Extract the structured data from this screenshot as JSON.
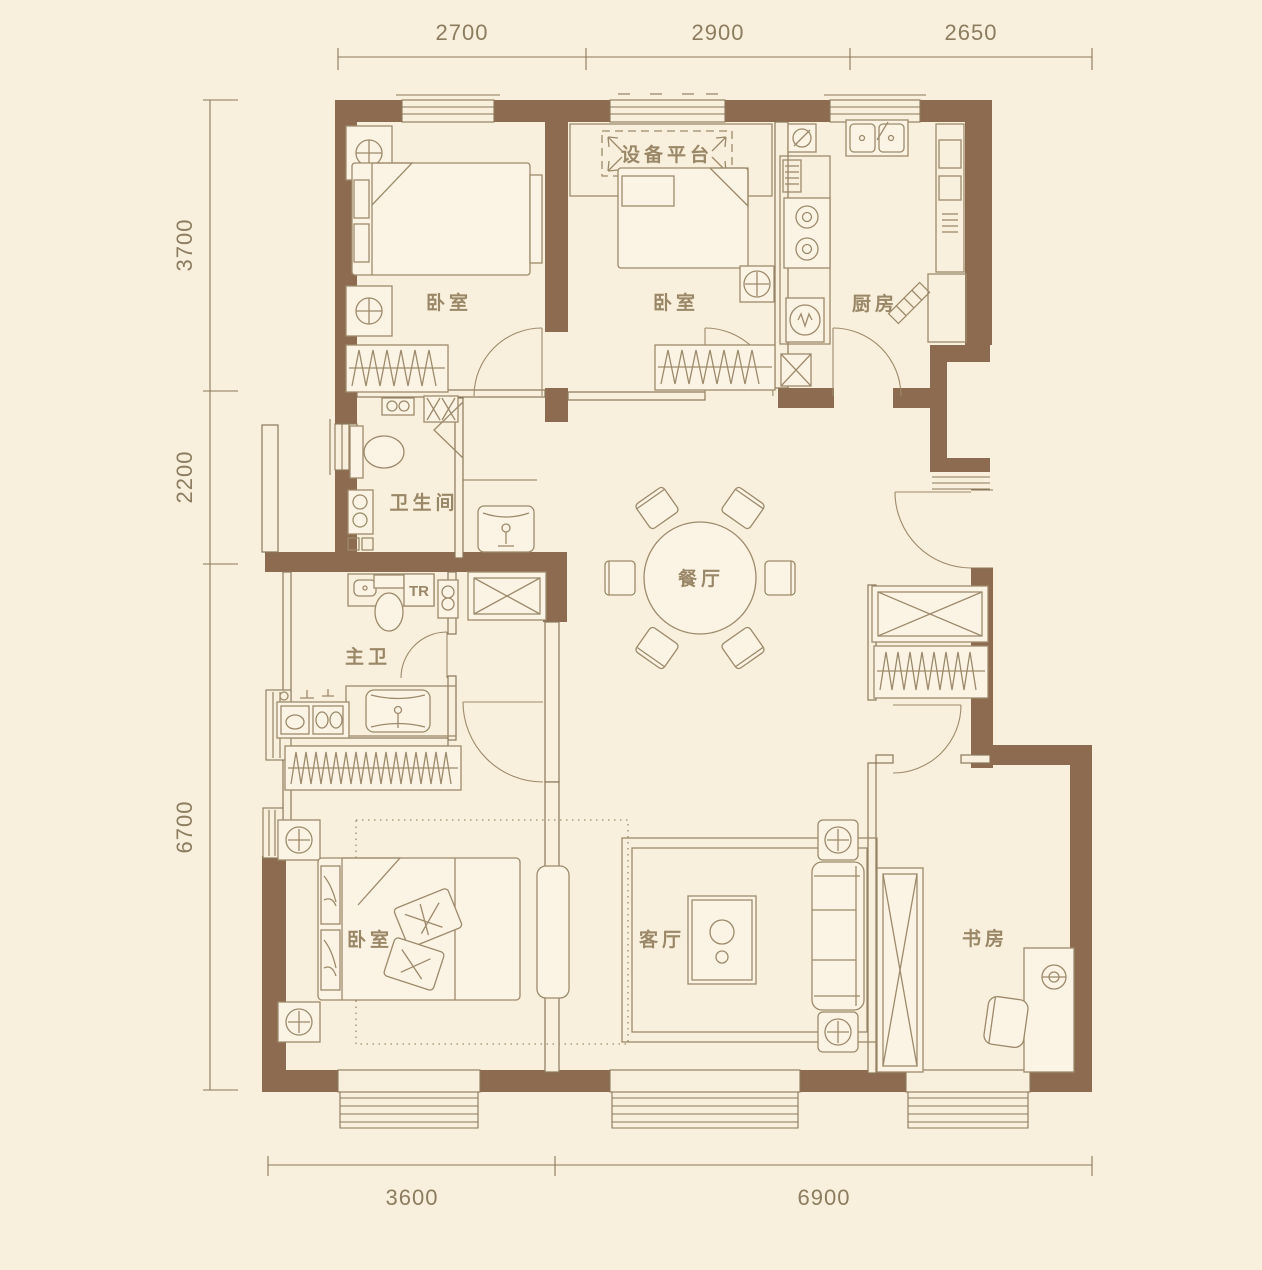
{
  "plan": {
    "wall_color": "#8d6b50",
    "line_color": "#8a775a",
    "furniture_line_color": "#9d8a6c",
    "label_color": "#9a8768",
    "dim_color": "#8c7c60",
    "background_color": "#f8f0dc"
  },
  "rooms": [
    {
      "id": "bedroom-1",
      "name": "卧室"
    },
    {
      "id": "bedroom-2",
      "name": "卧室"
    },
    {
      "id": "kitchen",
      "name": "厨房"
    },
    {
      "id": "bathroom",
      "name": "卫生间"
    },
    {
      "id": "master-bath",
      "name": "主卫"
    },
    {
      "id": "dining",
      "name": "餐厅"
    },
    {
      "id": "bedroom-3",
      "name": "卧室"
    },
    {
      "id": "living",
      "name": "客厅"
    },
    {
      "id": "study",
      "name": "书房"
    }
  ],
  "annotations": [
    {
      "id": "equipment-platform",
      "text": "设备平台"
    },
    {
      "id": "tr-riser",
      "text": "TR"
    }
  ],
  "dimensions": {
    "top": [
      {
        "value": "2700"
      },
      {
        "value": "2900"
      },
      {
        "value": "2650"
      }
    ],
    "left": [
      {
        "value": "3700"
      },
      {
        "value": "2200"
      },
      {
        "value": "6700"
      }
    ],
    "bottom": [
      {
        "value": "3600"
      },
      {
        "value": "6900"
      }
    ]
  }
}
